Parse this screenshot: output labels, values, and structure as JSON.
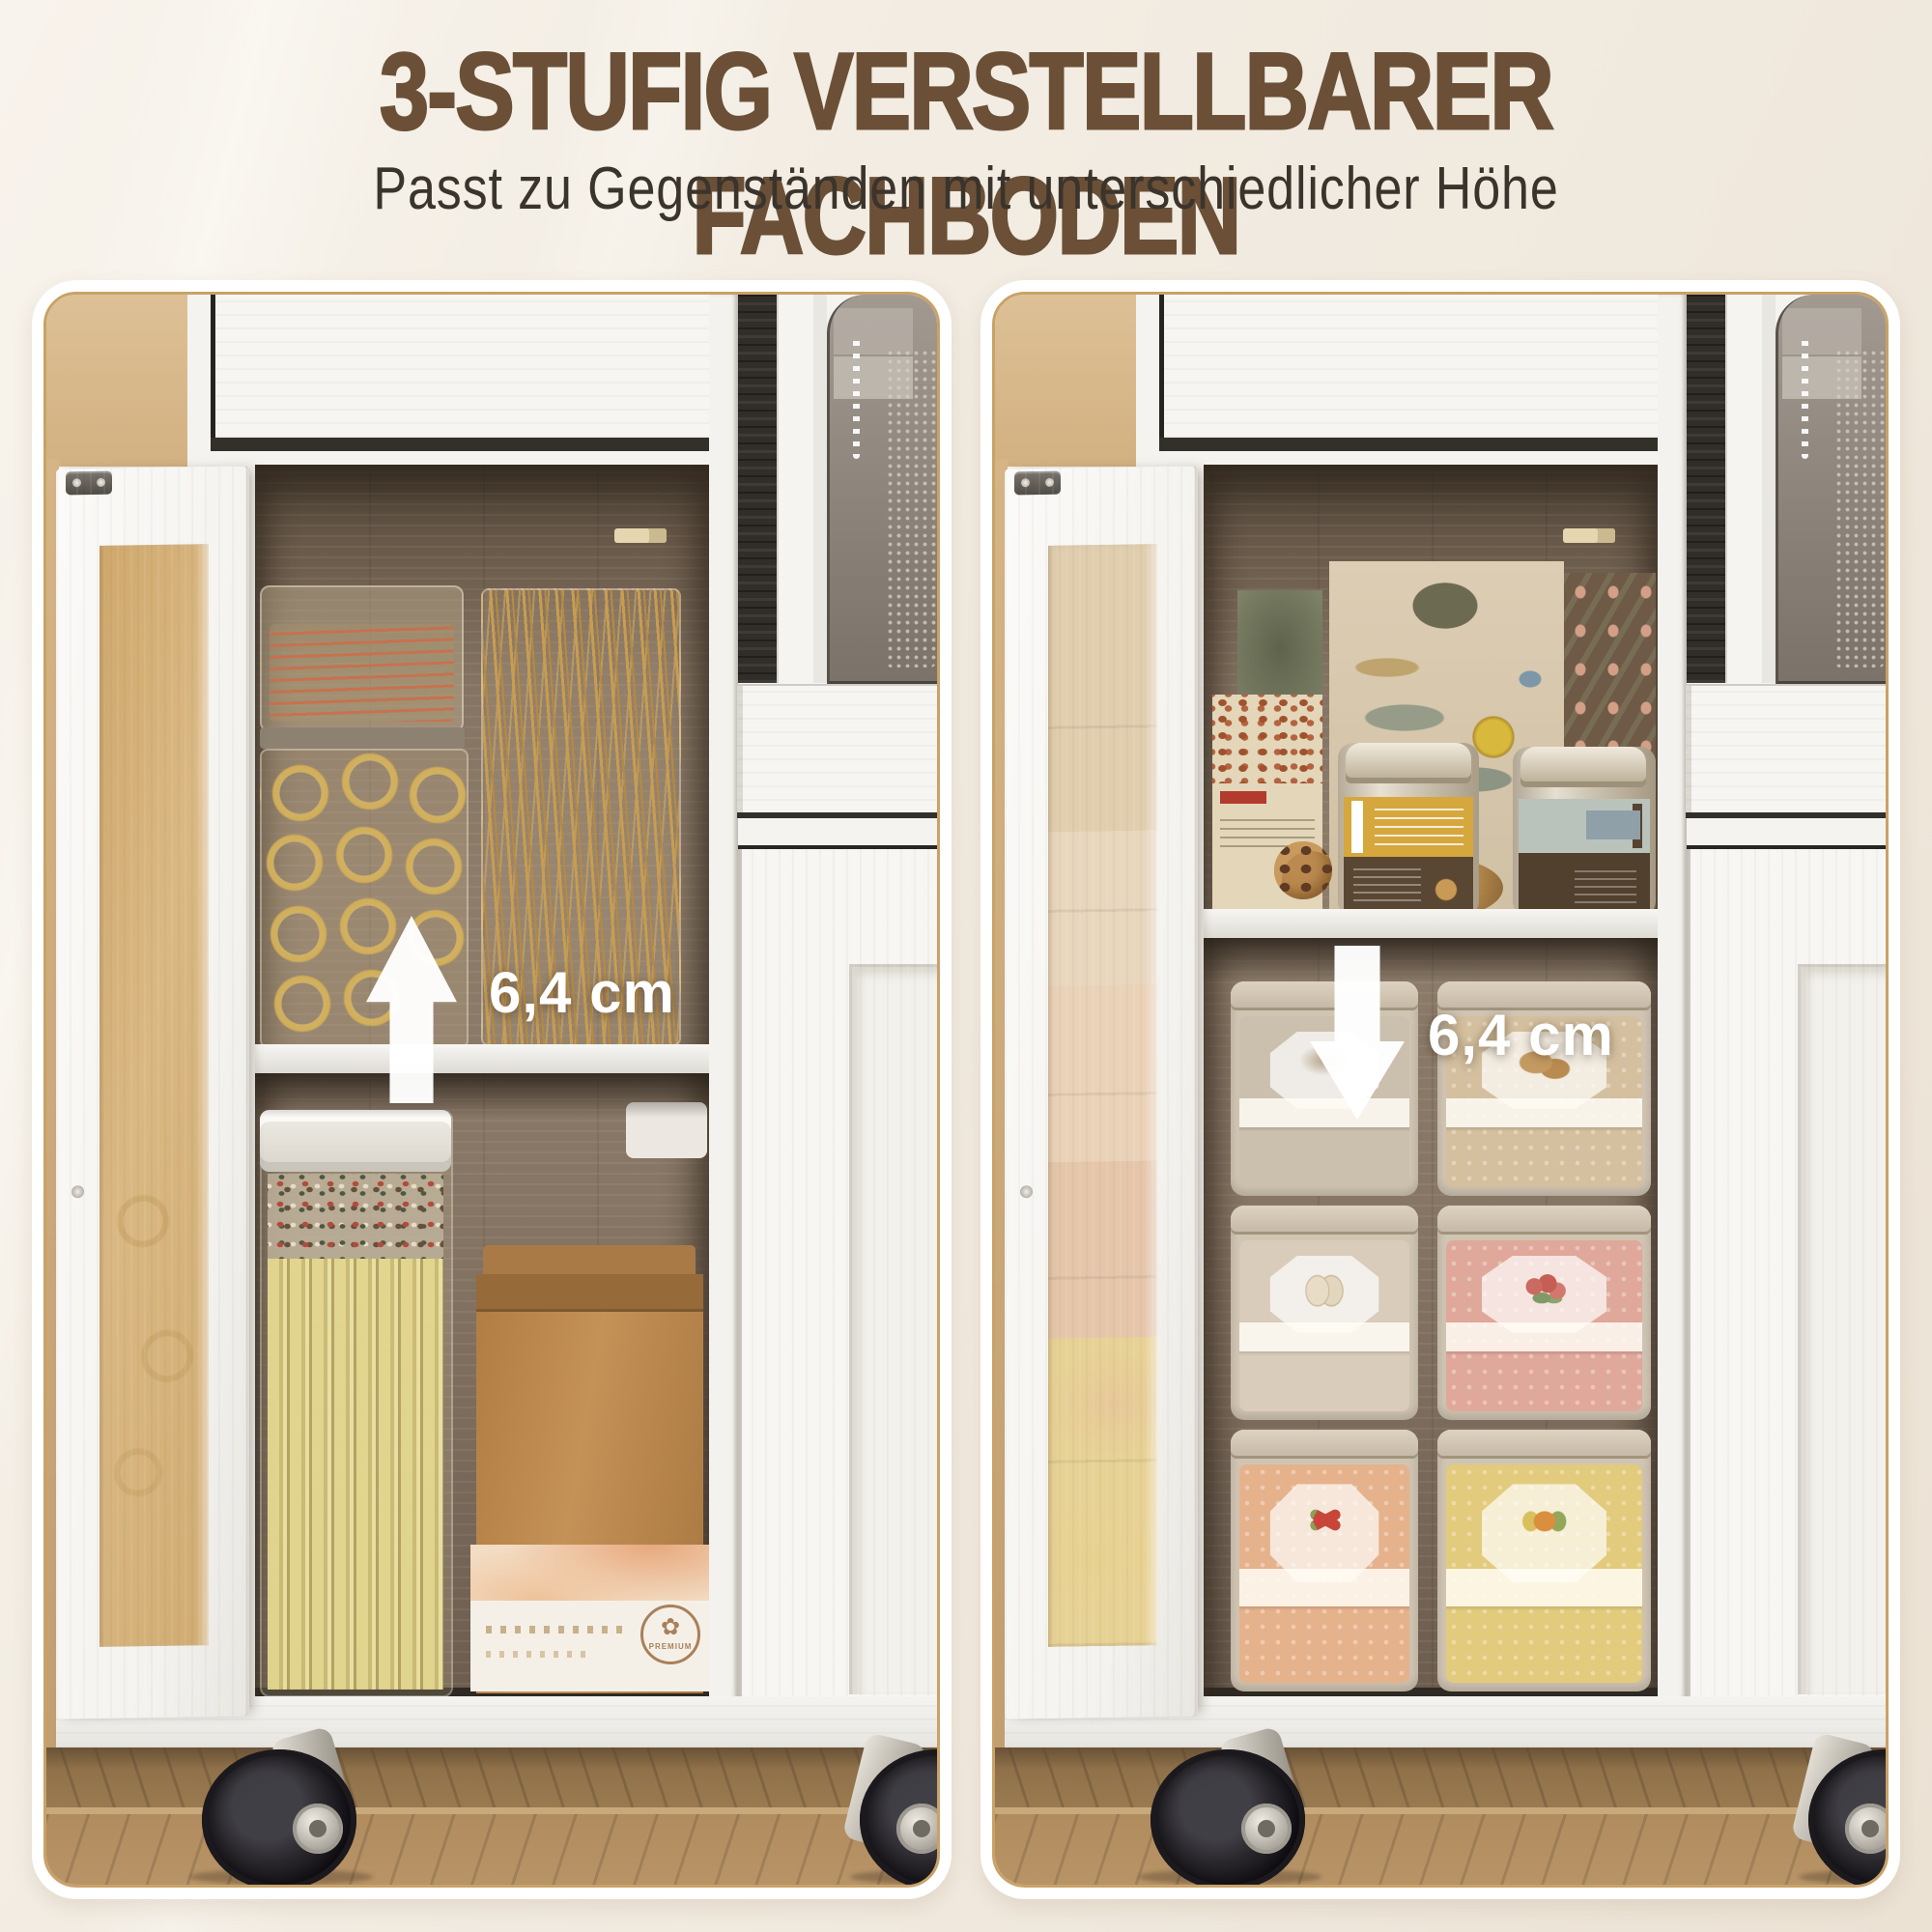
{
  "header": {
    "title": "3-STUFIG VERSTELLBARER FACHBODEN",
    "subtitle": "Passt zu Gegenständen mit unterschiedlicher Höhe"
  },
  "panels": [
    {
      "side": "left",
      "shelf_state": "shelf-in-lower-position",
      "measurement": "6,4 cm",
      "arrow_direction": "up",
      "arrow_icon": "arrow-up-icon",
      "visible_items": [
        "glass-container-with-pasta-strands",
        "glass-container-with-spaghetti",
        "glass-container-with-ring-pasta",
        "airtight-container-with-lasagna-and-peppercorns",
        "kraft-paper-bag",
        "coffee-box"
      ],
      "coffee_box": {
        "stamp": "PREMIUM"
      }
    },
    {
      "side": "right",
      "shelf_state": "shelf-in-upper-position",
      "measurement": "6,4 cm",
      "arrow_direction": "down",
      "arrow_icon": "arrow-down-icon",
      "visible_items": [
        "cereal-boxes",
        "cookie-box",
        "two-metal-coffee-tins",
        "six-square-storage-tins-with-vintage-labels"
      ]
    }
  ],
  "furniture": {
    "parts": [
      "white-kitchen-trolley",
      "glass-door",
      "adjustable-shelf",
      "microwave-compartment",
      "drawer",
      "caster-wheels",
      "wood-floor"
    ]
  },
  "colors": {
    "page_background": "#f2ebe1",
    "title": "#6b5037",
    "subtitle": "#3a342c",
    "panel_border": "#c9a267",
    "panel_background": "#ffffff",
    "wall": "#d9bb8e",
    "cabinet_white": "#f6f5f2",
    "interior_wood": "#84735f",
    "floor_wood": "#a4835a",
    "arrow": "#ffffff",
    "measurement_text": "#ffffff"
  }
}
